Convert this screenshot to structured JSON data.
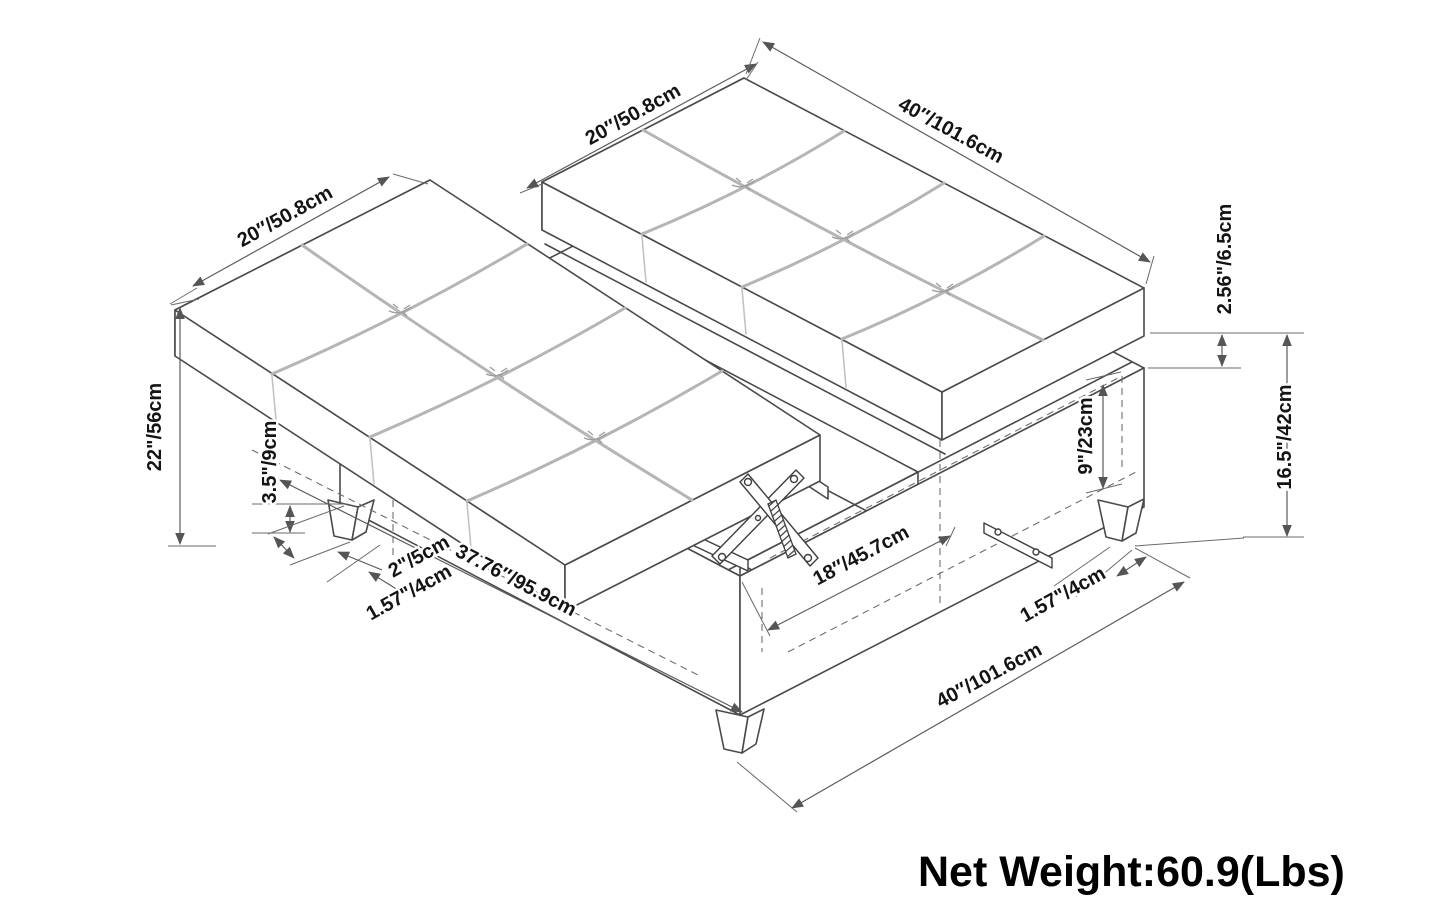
{
  "diagram": {
    "labels": {
      "cushion_width_left": "20″/50.8cm",
      "cushion_width_right": "20″/50.8cm",
      "length_top": "40″/101.6cm",
      "cushion_lip": "2.56\"/6.5cm",
      "base_height": "16.5\"/42cm",
      "storage_depth": "9\"/23cm",
      "overall_height": "22\"/56cm",
      "leg_height": "3.5\"/9cm",
      "leg_top_width": "2\"/5cm",
      "leg_bottom_width_left": "1.57\"/4cm",
      "lid_length": "37.76″/95.9cm",
      "opening_length": "18″/45.7cm",
      "leg_bottom_width_right": "1.57\"/4cm",
      "length_bottom": "40″/101.6cm"
    },
    "net_weight": "Net Weight:60.9(Lbs)",
    "colors": {
      "line": "#4a4a4a",
      "seam": "#b5b5b5",
      "dimension": "#5c5c5c",
      "text": "#141414",
      "background": "#ffffff"
    }
  }
}
